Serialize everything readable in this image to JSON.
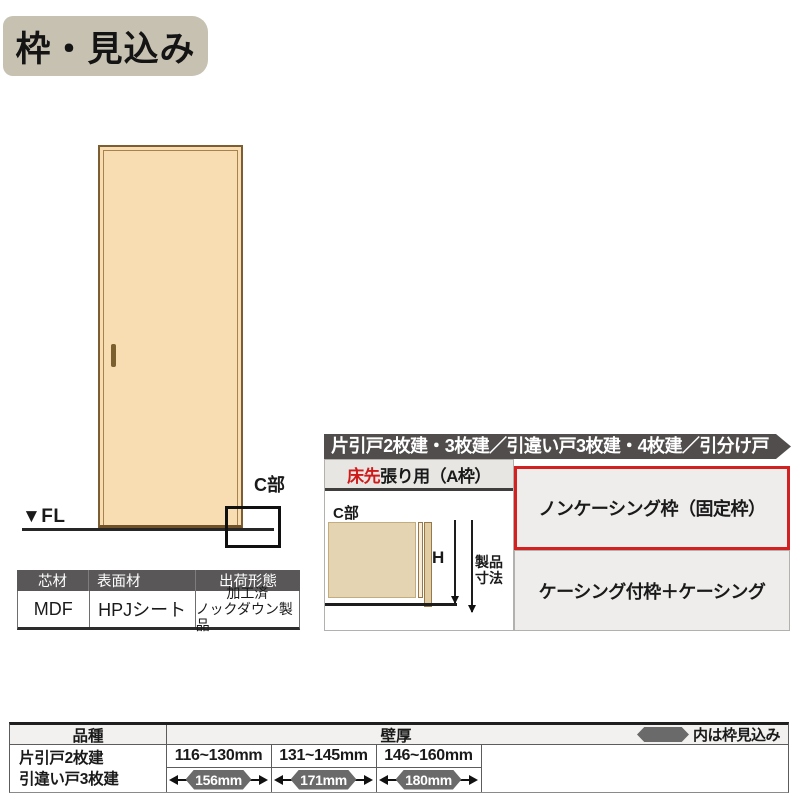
{
  "page": {
    "title": "枠・見込み"
  },
  "door_figure": {
    "fl_label": "▼FL",
    "c_section_label": "C部"
  },
  "materials_table": {
    "headers": [
      "芯材",
      "表面材",
      "出荷形態"
    ],
    "core": "MDF",
    "surface": "HPJシート",
    "shipping_line1": "加工済",
    "shipping_line2": "ノックダウン製品"
  },
  "right_section": {
    "header_bar": "片引戸2枚建・3枚建／引違い戸3枚建・4枚建／引分け戸",
    "subtitle_red": "床先",
    "subtitle_rest": "張り用（A枠）",
    "diagram": {
      "c_section_label": "C部",
      "height_label": "H",
      "dim_note_line1": "製品",
      "dim_note_line2": "寸法"
    },
    "options": [
      {
        "label": "ノンケーシング枠（固定枠）",
        "selected": true
      },
      {
        "label": "ケーシング付枠＋ケーシング",
        "selected": false
      }
    ]
  },
  "spec_table": {
    "kind_header": "品種",
    "wall_header": "壁厚",
    "legend_note": "内は枠見込み",
    "products": [
      "片引戸2枚建",
      "引違い戸3枚建"
    ],
    "columns": [
      {
        "wall_range": "116~130mm",
        "frame_depth": "156mm"
      },
      {
        "wall_range": "131~145mm",
        "frame_depth": "171mm"
      },
      {
        "wall_range": "146~160mm",
        "frame_depth": "180mm"
      }
    ]
  },
  "colors": {
    "title_badge_bg": "#c7c1b2",
    "door_fill": "#f8dcb2",
    "door_frame": "#7d5e33",
    "type_bar_bg": "#514d4d",
    "option_cell_bg": "#eeedeb",
    "highlight_red": "#d32020",
    "table_header_dark_bg": "#595757",
    "badge_bg": "#6a6a6a"
  }
}
